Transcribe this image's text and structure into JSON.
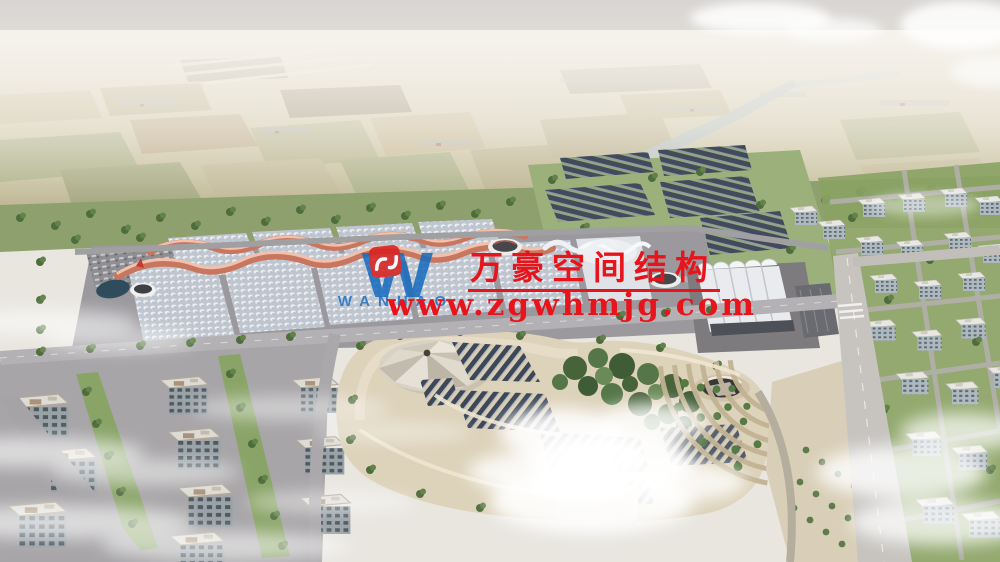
{
  "watermark": {
    "logo_mark": "W",
    "logo_text": "WANHAO",
    "company_name_cn": "万豪空间结构",
    "website_url": "www.zgwhmjg.com",
    "colors": {
      "brand_blue": "#1a6dc0",
      "brand_red": "#e8141b",
      "emblem_red": "#d6201f"
    }
  },
  "scene": {
    "description": "Aerial architectural rendering: exhibition-hall campus with red wavy roof ridges, white vaulted hall, rooftop solar farm, circular tent pavilion in a central park, surrounding residential blocks, farmland horizon, river and clouds",
    "palette": {
      "sky_top": "#d7d4d1",
      "haze": "#f3f0ea",
      "field_tan": "#cdc4a6",
      "field_green": "#9aa878",
      "tree_dark": "#4a643c",
      "grass": "#9cb07c",
      "road_gray": "#a8a6a8",
      "road_light": "#c7c4c0",
      "plaza_gray": "#9b999d",
      "hall_roof": "#c6ccd4",
      "ridge_red": "#c8765f",
      "shell_white": "#eef1f4",
      "solar_panel": "#414b5c",
      "park_sand": "#ddd2ba",
      "pond_water": "#2f4c5c",
      "river": "#b7c3c6",
      "city_facade": "#aab8bd",
      "city_roof": "#e9e7e2",
      "cloud": "#ffffff"
    }
  }
}
